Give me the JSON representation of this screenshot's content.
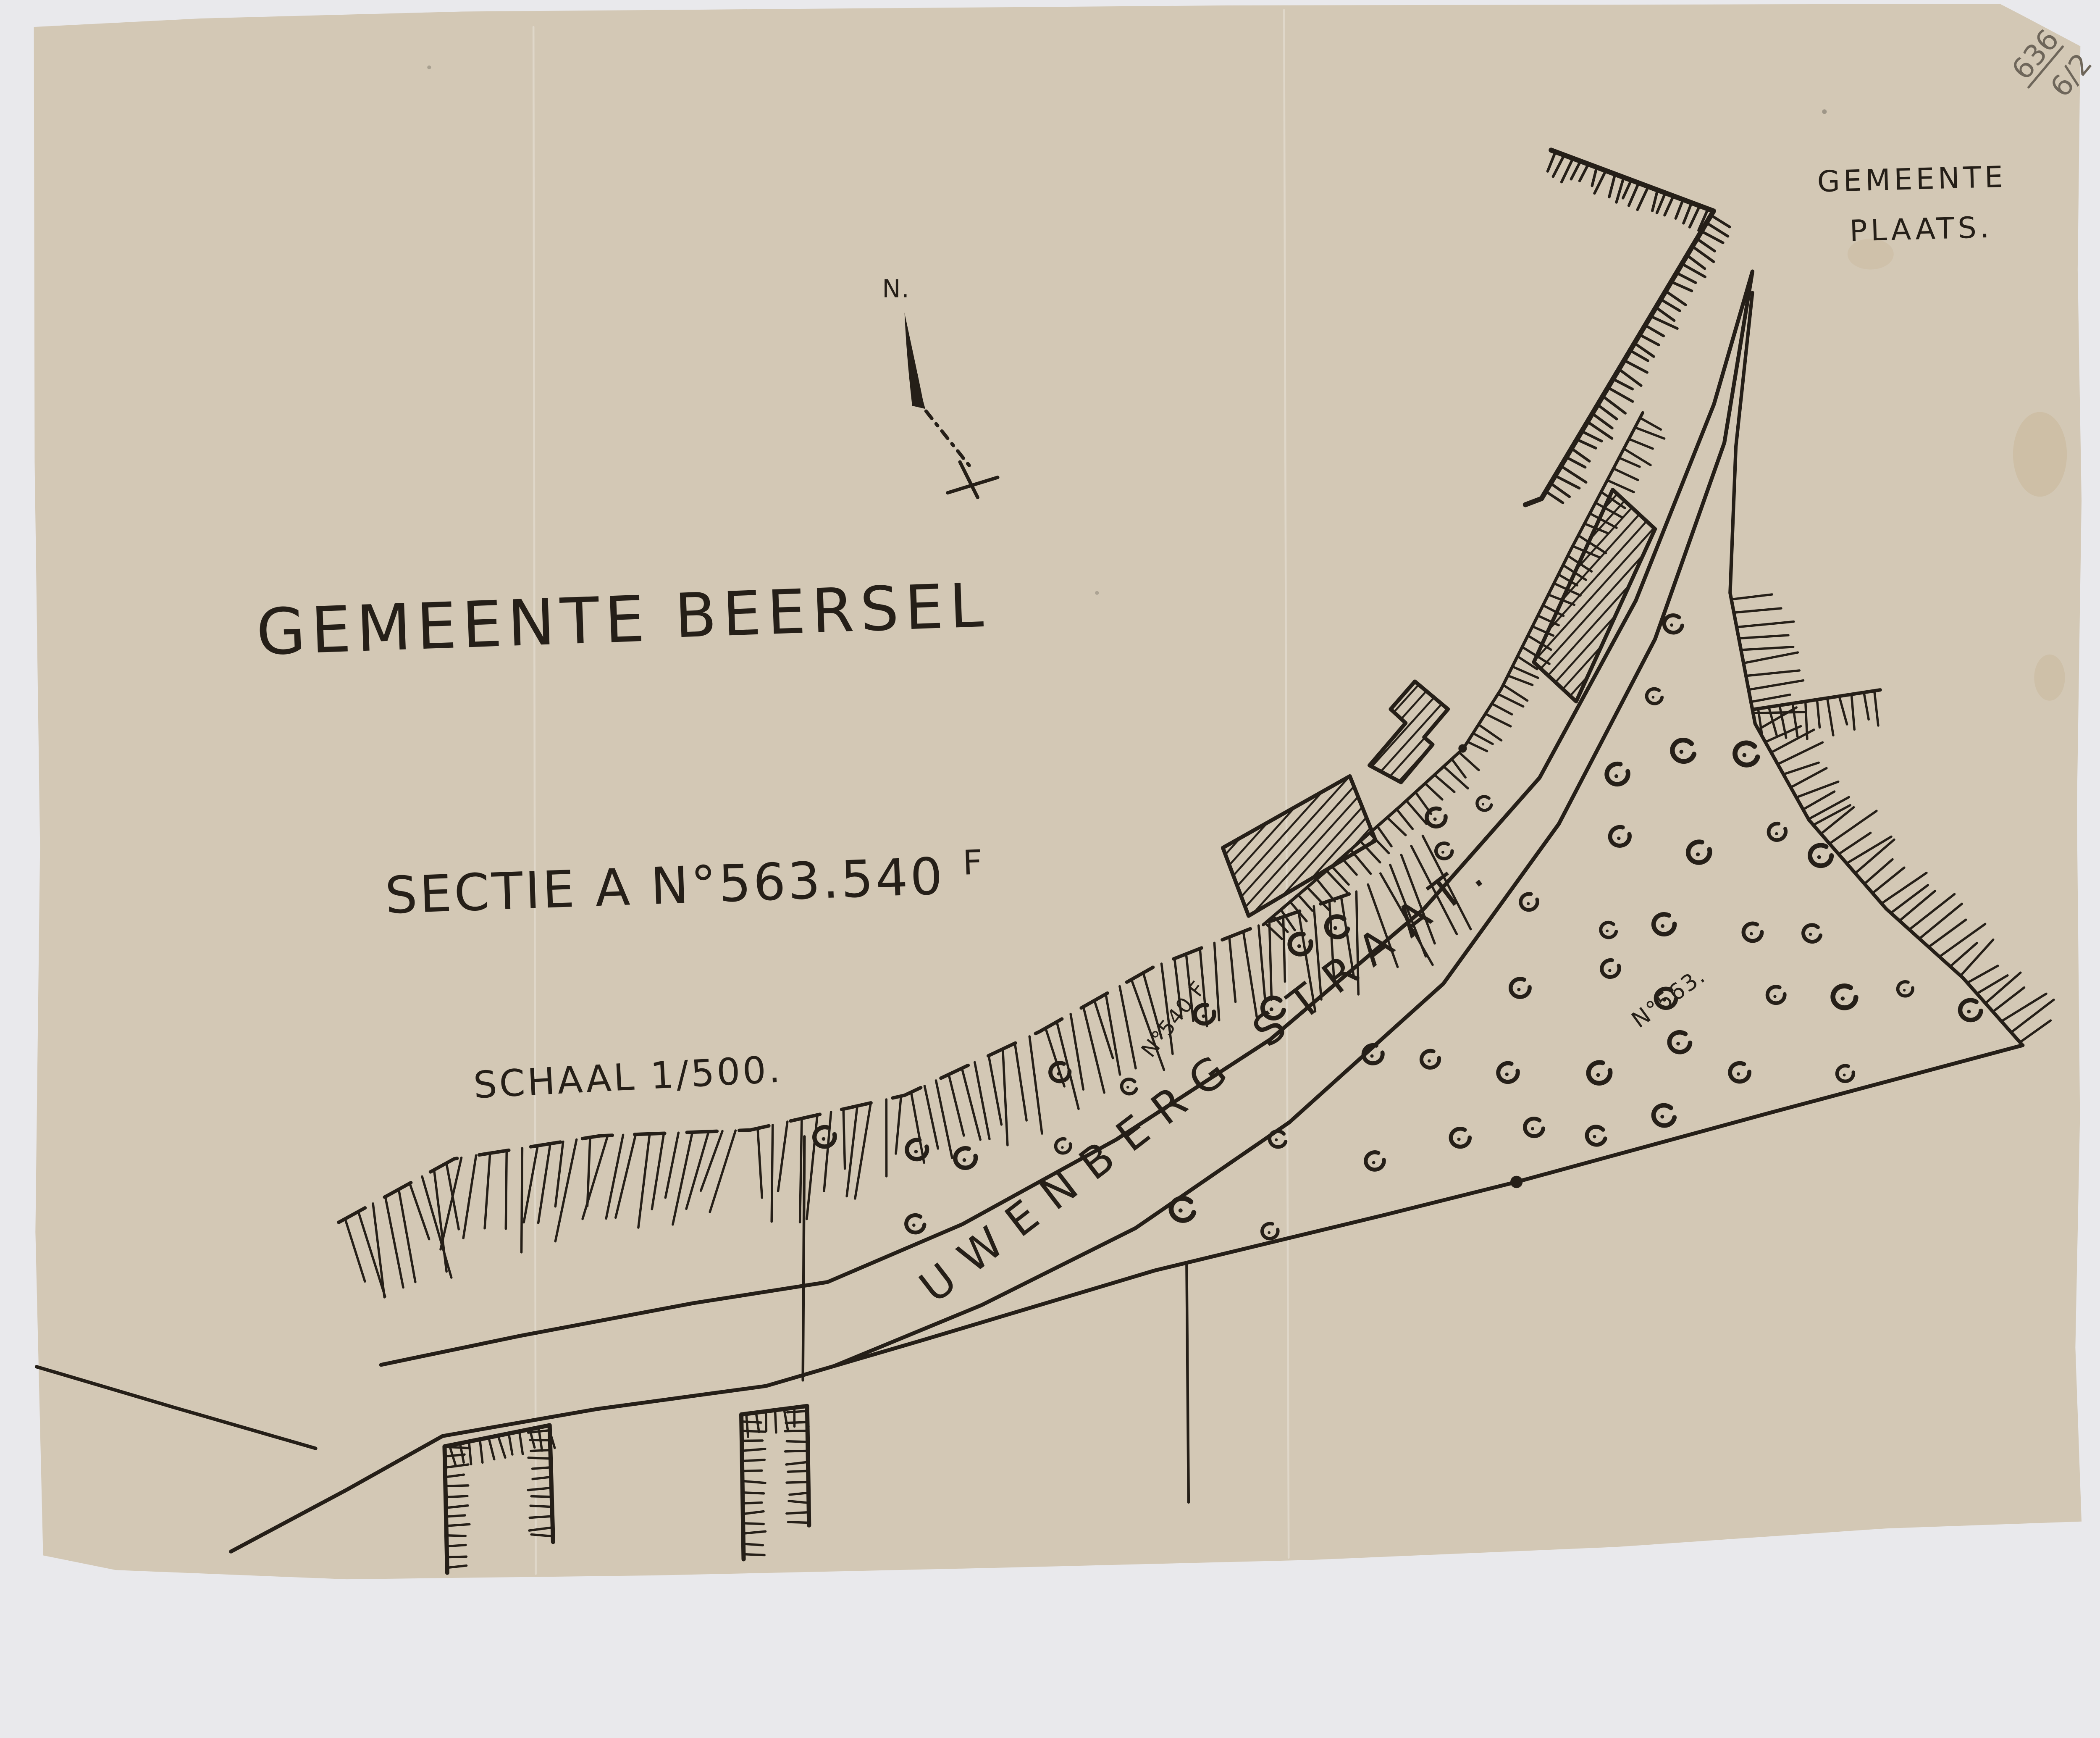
{
  "page": {
    "background_color": "#e9e9ec"
  },
  "paper": {
    "color": "#d3c8b5",
    "crease_color": "rgba(255,255,255,0.28)"
  },
  "ink": {
    "color": "#251f18",
    "pencil_color": "#6e665a"
  },
  "header": {
    "pencil_note_top": "636",
    "pencil_note_bottom": "6/2",
    "region_line1": "GEMEENTE",
    "region_line2": "PLAATS."
  },
  "title": {
    "word1": "GEMEENTE",
    "word2": "BEERSEL"
  },
  "section": {
    "main": "SECTIE A N°563.540",
    "sup": "F"
  },
  "scale": {
    "label": "SCHAAL 1/500."
  },
  "compass": {
    "label": "N."
  },
  "street": {
    "label": "UWENBERG STRAAT."
  },
  "parcels": {
    "parcel_540": "N°540 F",
    "parcel_563": "N°563."
  }
}
